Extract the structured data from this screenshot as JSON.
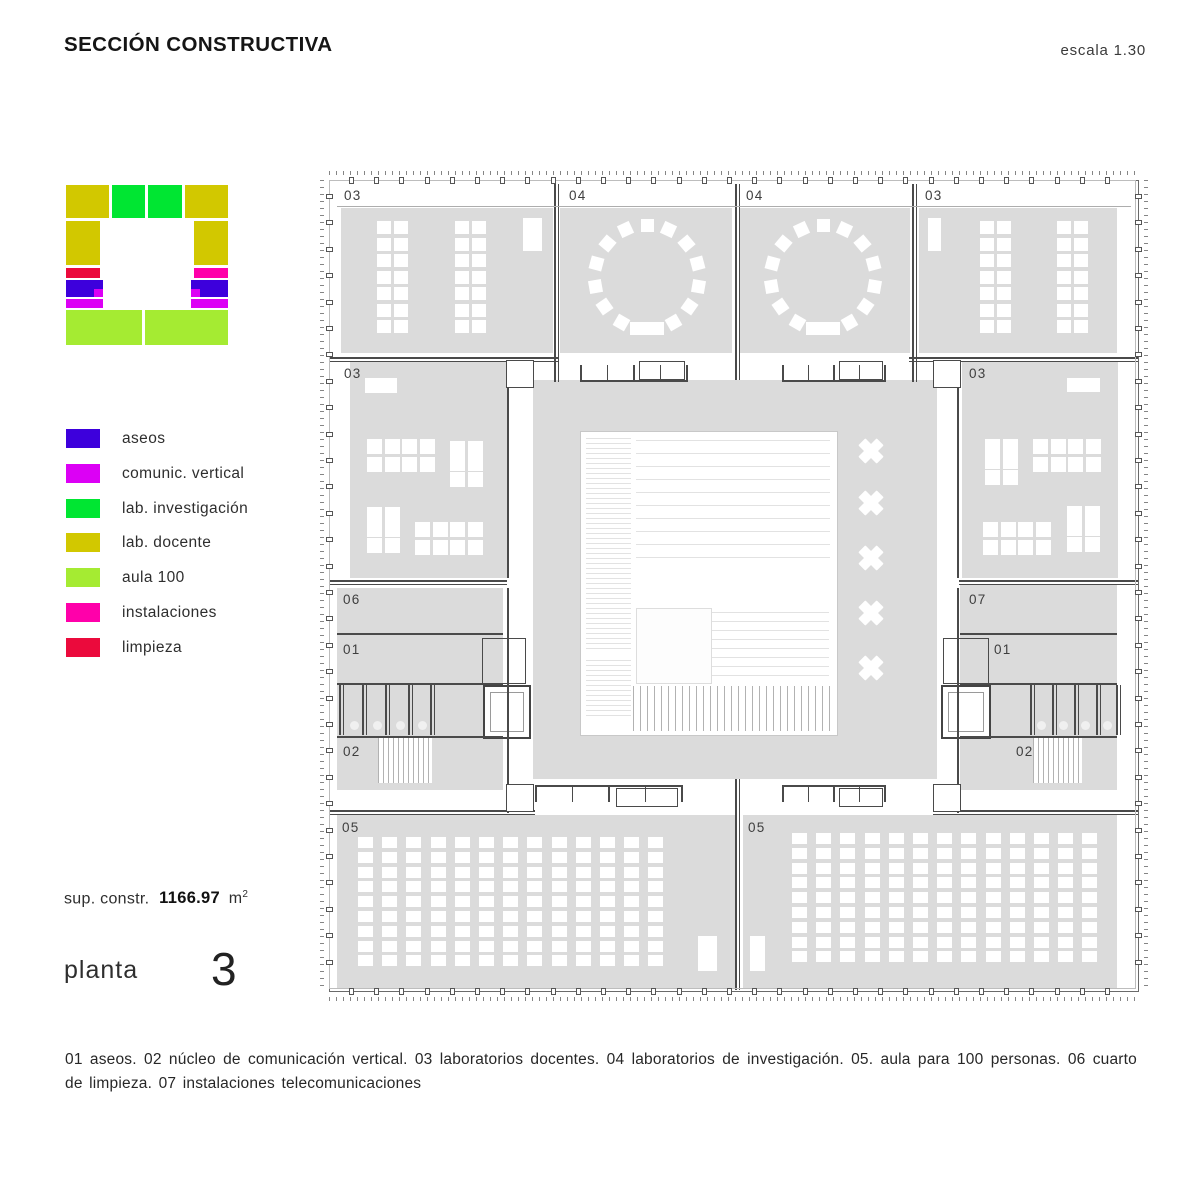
{
  "header": {
    "title": "SECCIÓN CONSTRUCTIVA",
    "scale": "escala 1.30"
  },
  "palette": {
    "aseos": "#3D00DC",
    "comunic": "#DC00F5",
    "invest": "#00E632",
    "docente": "#D2C800",
    "aula": "#A5EB32",
    "instal": "#FF00AA",
    "limpieza": "#EB0A3C"
  },
  "legend": {
    "items": [
      {
        "key": "aseos",
        "label": "aseos"
      },
      {
        "key": "comunic",
        "label": "comunic. vertical"
      },
      {
        "key": "invest",
        "label": "lab. investigación"
      },
      {
        "key": "docente",
        "label": "lab. docente"
      },
      {
        "key": "aula",
        "label": "aula 100"
      },
      {
        "key": "instal",
        "label": "instalaciones"
      },
      {
        "key": "limpieza",
        "label": "limpieza"
      }
    ]
  },
  "key_plan": {
    "blocks": [
      {
        "x": 0,
        "y": 2,
        "w": 43,
        "h": 33,
        "k": "docente"
      },
      {
        "x": 46,
        "y": 2,
        "w": 33,
        "h": 33,
        "k": "invest"
      },
      {
        "x": 82,
        "y": 2,
        "w": 34,
        "h": 33,
        "k": "invest"
      },
      {
        "x": 119,
        "y": 2,
        "w": 43,
        "h": 33,
        "k": "docente"
      },
      {
        "x": 0,
        "y": 38,
        "w": 34,
        "h": 44,
        "k": "docente"
      },
      {
        "x": 128,
        "y": 38,
        "w": 34,
        "h": 44,
        "k": "docente"
      },
      {
        "x": 0,
        "y": 85,
        "w": 34,
        "h": 10,
        "k": "limpieza"
      },
      {
        "x": 128,
        "y": 85,
        "w": 34,
        "h": 10,
        "k": "instal"
      },
      {
        "x": 0,
        "y": 97,
        "w": 37,
        "h": 17,
        "k": "aseos"
      },
      {
        "x": 125,
        "y": 97,
        "w": 37,
        "h": 17,
        "k": "aseos"
      },
      {
        "x": 28,
        "y": 106,
        "w": 9,
        "h": 8,
        "k": "comunic"
      },
      {
        "x": 125,
        "y": 106,
        "w": 9,
        "h": 8,
        "k": "comunic"
      },
      {
        "x": 0,
        "y": 116,
        "w": 37,
        "h": 9,
        "k": "comunic"
      },
      {
        "x": 125,
        "y": 116,
        "w": 37,
        "h": 9,
        "k": "comunic"
      },
      {
        "x": 0,
        "y": 127,
        "w": 76,
        "h": 35,
        "k": "aula"
      },
      {
        "x": 79,
        "y": 127,
        "w": 83,
        "h": 35,
        "k": "aula"
      }
    ]
  },
  "stats": {
    "prefix": "sup. constr.",
    "value": "1166.97",
    "unit": "m",
    "sup": "2"
  },
  "floor": {
    "label": "planta",
    "number": "3"
  },
  "caption": {
    "text": "01 aseos. 02 núcleo de comunicación vertical. 03 laboratorios docentes. 04 laboratorios de investigación. 05. aula para 100 personas. 06 cuarto de limpieza. 07 instalaciones telecomunicaciones"
  },
  "plan": {
    "room_fill": "#dbdbdb",
    "wall_color": "#4a4a4a",
    "rooms": [
      {
        "label": "03",
        "x": 12,
        "y": 28,
        "w": 212,
        "h": 145,
        "lx": 15,
        "ly": 8
      },
      {
        "label": "04",
        "x": 231,
        "y": 28,
        "w": 172,
        "h": 145,
        "lx": 240,
        "ly": 8
      },
      {
        "label": "04",
        "x": 411,
        "y": 28,
        "w": 170,
        "h": 145,
        "lx": 417,
        "ly": 8
      },
      {
        "label": "03",
        "x": 590,
        "y": 28,
        "w": 198,
        "h": 145,
        "lx": 596,
        "ly": 8
      },
      {
        "label": "03",
        "x": 21,
        "y": 182,
        "w": 157,
        "h": 216,
        "lx": 15,
        "ly": 186
      },
      {
        "label": "03",
        "x": 633,
        "y": 182,
        "w": 156,
        "h": 216,
        "lx": 640,
        "ly": 186
      },
      {
        "label": "06",
        "x": 8,
        "y": 408,
        "w": 166,
        "h": 45,
        "lx": 14,
        "ly": 412
      },
      {
        "label": "07",
        "x": 631,
        "y": 405,
        "w": 157,
        "h": 48,
        "lx": 640,
        "ly": 412
      },
      {
        "label": "01",
        "x": 8,
        "y": 454,
        "w": 166,
        "h": 102,
        "lx": 14,
        "ly": 462
      },
      {
        "label": "01",
        "x": 631,
        "y": 454,
        "w": 157,
        "h": 102,
        "lx": 665,
        "ly": 462
      },
      {
        "label": "02",
        "x": 8,
        "y": 557,
        "w": 166,
        "h": 53,
        "lx": 14,
        "ly": 564
      },
      {
        "label": "02",
        "x": 631,
        "y": 557,
        "w": 157,
        "h": 53,
        "lx": 687,
        "ly": 564
      },
      {
        "label": "05",
        "x": 8,
        "y": 635,
        "w": 398,
        "h": 174,
        "lx": 13,
        "ly": 640
      },
      {
        "label": "05",
        "x": 414,
        "y": 635,
        "w": 374,
        "h": 174,
        "lx": 419,
        "ly": 640
      },
      {
        "label": "",
        "x": 204,
        "y": 200,
        "w": 404,
        "h": 399,
        "lx": 0,
        "ly": 0
      }
    ],
    "courtyard": {
      "x": 251,
      "y": 251,
      "w": 256,
      "h": 303
    },
    "louvers": [
      {
        "x": 257,
        "y": 258,
        "w": 45,
        "h": 212,
        "p": 5
      },
      {
        "x": 307,
        "y": 260,
        "w": 194,
        "h": 128,
        "p": 13
      },
      {
        "x": 382,
        "y": 432,
        "w": 118,
        "h": 66,
        "p": 9
      },
      {
        "x": 257,
        "y": 480,
        "w": 45,
        "h": 58,
        "p": 5
      }
    ],
    "panels": [
      {
        "x": 307,
        "y": 428,
        "w": 74,
        "h": 74
      }
    ],
    "stairs": [
      {
        "x": 304,
        "y": 506,
        "w": 198,
        "h": 45,
        "p": 7
      },
      {
        "x": 49,
        "y": 558,
        "w": 54,
        "h": 45,
        "p": 5
      },
      {
        "x": 704,
        "y": 557,
        "w": 49,
        "h": 46,
        "p": 5
      }
    ],
    "xcolumns": {
      "cx": 542,
      "size": 26,
      "ys": [
        271,
        323,
        378,
        433,
        488
      ]
    },
    "grids": [
      {
        "x": 48,
        "y": 41,
        "cols": 2,
        "rows": 7,
        "cw": 14,
        "ch": 13,
        "px": 17,
        "py": 16.5
      },
      {
        "x": 126,
        "y": 41,
        "cols": 2,
        "rows": 7,
        "cw": 14,
        "ch": 13,
        "px": 17,
        "py": 16.5
      },
      {
        "x": 651,
        "y": 41,
        "cols": 2,
        "rows": 7,
        "cw": 14,
        "ch": 13,
        "px": 17,
        "py": 16.5
      },
      {
        "x": 728,
        "y": 41,
        "cols": 2,
        "rows": 7,
        "cw": 14,
        "ch": 13,
        "px": 17,
        "py": 16.5
      },
      {
        "x": 38,
        "y": 259,
        "cols": 4,
        "rows": 2,
        "cw": 15,
        "ch": 15,
        "px": 17.5,
        "py": 17.5
      },
      {
        "x": 121,
        "y": 261,
        "cols": 2,
        "rows": 3,
        "cw": 15,
        "ch": 15,
        "px": 17.5,
        "py": 15.3
      },
      {
        "x": 38,
        "y": 327,
        "cols": 2,
        "rows": 3,
        "cw": 15,
        "ch": 15,
        "px": 17.5,
        "py": 15.3
      },
      {
        "x": 86,
        "y": 342,
        "cols": 4,
        "rows": 2,
        "cw": 15,
        "ch": 15,
        "px": 17.5,
        "py": 17.5
      },
      {
        "x": 656,
        "y": 259,
        "cols": 2,
        "rows": 3,
        "cw": 15,
        "ch": 15,
        "px": 17.5,
        "py": 15.3
      },
      {
        "x": 704,
        "y": 259,
        "cols": 4,
        "rows": 2,
        "cw": 15,
        "ch": 15,
        "px": 17.5,
        "py": 17.5
      },
      {
        "x": 654,
        "y": 342,
        "cols": 4,
        "rows": 2,
        "cw": 15,
        "ch": 15,
        "px": 17.5,
        "py": 17.5
      },
      {
        "x": 738,
        "y": 326,
        "cols": 2,
        "rows": 3,
        "cw": 15,
        "ch": 15,
        "px": 17.5,
        "py": 15.3
      },
      {
        "x": 29,
        "y": 657,
        "cols": 13,
        "rows": 9,
        "cw": 15,
        "ch": 11,
        "px": 24.2,
        "py": 14.8
      },
      {
        "x": 463,
        "y": 653,
        "cols": 13,
        "rows": 9,
        "cw": 15,
        "ch": 11,
        "px": 24.2,
        "py": 14.8
      }
    ],
    "rects": [
      {
        "x": 194,
        "y": 38,
        "w": 19,
        "h": 33
      },
      {
        "x": 599,
        "y": 38,
        "w": 13,
        "h": 33
      },
      {
        "x": 36,
        "y": 198,
        "w": 32,
        "h": 15
      },
      {
        "x": 738,
        "y": 198,
        "w": 33,
        "h": 14
      },
      {
        "x": 301,
        "y": 142,
        "w": 34,
        "h": 13
      },
      {
        "x": 477,
        "y": 142,
        "w": 34,
        "h": 13
      },
      {
        "x": 369,
        "y": 756,
        "w": 19,
        "h": 35
      },
      {
        "x": 421,
        "y": 756,
        "w": 15,
        "h": 35
      }
    ],
    "rings": [
      {
        "cx": 318,
        "cy": 97,
        "r": 52,
        "n": 13,
        "s": 13,
        "start": 120,
        "step": 25
      },
      {
        "cx": 494,
        "cy": 97,
        "r": 52,
        "n": 13,
        "s": 13,
        "start": 120,
        "step": 25
      }
    ],
    "walls": [
      {
        "x": 225,
        "y": 4,
        "w": 1.5,
        "h": 198
      },
      {
        "x": 228.5,
        "y": 4,
        "w": 1.5,
        "h": 198
      },
      {
        "x": 406,
        "y": 4,
        "w": 1.5,
        "h": 196
      },
      {
        "x": 409.5,
        "y": 4,
        "w": 1.5,
        "h": 196
      },
      {
        "x": 583,
        "y": 4,
        "w": 1.5,
        "h": 198
      },
      {
        "x": 586.5,
        "y": 4,
        "w": 1.5,
        "h": 198
      },
      {
        "x": 406,
        "y": 599,
        "w": 1.5,
        "h": 211
      },
      {
        "x": 409.5,
        "y": 599,
        "w": 1.5,
        "h": 211
      },
      {
        "x": 178,
        "y": 182,
        "w": 1.5,
        "h": 216
      },
      {
        "x": 628,
        "y": 182,
        "w": 1.5,
        "h": 216
      },
      {
        "x": 178,
        "y": 408,
        "w": 1.5,
        "h": 225
      },
      {
        "x": 628,
        "y": 408,
        "w": 1.5,
        "h": 225
      },
      {
        "x": 0,
        "y": 177,
        "w": 230,
        "h": 1.5
      },
      {
        "x": 0,
        "y": 180.5,
        "w": 230,
        "h": 1.5
      },
      {
        "x": 580,
        "y": 177,
        "w": 230,
        "h": 1.5
      },
      {
        "x": 580,
        "y": 180.5,
        "w": 230,
        "h": 1.5
      },
      {
        "x": 0,
        "y": 400,
        "w": 178,
        "h": 1.5
      },
      {
        "x": 0,
        "y": 403.5,
        "w": 178,
        "h": 1.5
      },
      {
        "x": 630,
        "y": 400,
        "w": 180,
        "h": 1.5
      },
      {
        "x": 630,
        "y": 403.5,
        "w": 180,
        "h": 1.5
      },
      {
        "x": 8,
        "y": 453,
        "w": 166,
        "h": 1.5
      },
      {
        "x": 631,
        "y": 453,
        "w": 157,
        "h": 1.5
      },
      {
        "x": 8,
        "y": 503,
        "w": 166,
        "h": 1.5
      },
      {
        "x": 631,
        "y": 503,
        "w": 157,
        "h": 1.5
      },
      {
        "x": 8,
        "y": 556,
        "w": 166,
        "h": 1.5
      },
      {
        "x": 631,
        "y": 556,
        "w": 157,
        "h": 1.5
      },
      {
        "x": 0,
        "y": 630,
        "w": 206,
        "h": 1.5
      },
      {
        "x": 0,
        "y": 633.5,
        "w": 206,
        "h": 1.5
      },
      {
        "x": 604,
        "y": 630,
        "w": 206,
        "h": 1.5
      },
      {
        "x": 604,
        "y": 633.5,
        "w": 206,
        "h": 1.5
      }
    ],
    "lines": [
      {
        "x": 8,
        "y": 26,
        "w": 794,
        "h": 1
      }
    ],
    "benches": [
      {
        "x": 251,
        "y": 178,
        "w": 108,
        "flip": false
      },
      {
        "x": 453,
        "y": 178,
        "w": 104,
        "flip": false
      },
      {
        "x": 206,
        "y": 605,
        "w": 148,
        "flip": true
      },
      {
        "x": 453,
        "y": 605,
        "w": 104,
        "flip": true
      }
    ],
    "corners": [
      {
        "x": 177,
        "y": 180
      },
      {
        "x": 604,
        "y": 180
      },
      {
        "x": 177,
        "y": 604
      },
      {
        "x": 604,
        "y": 604
      }
    ],
    "stalls": [
      {
        "xs": [
          10,
          33,
          56,
          79,
          101
        ],
        "y": 505,
        "h": 50
      },
      {
        "xs": [
          701,
          723,
          745,
          767,
          787
        ],
        "y": 505,
        "h": 50
      }
    ],
    "circles": [
      {
        "x": 25,
        "y": 545
      },
      {
        "x": 48,
        "y": 545
      },
      {
        "x": 71,
        "y": 545
      },
      {
        "x": 93,
        "y": 545
      },
      {
        "x": 712,
        "y": 545
      },
      {
        "x": 734,
        "y": 545
      },
      {
        "x": 756,
        "y": 545
      },
      {
        "x": 778,
        "y": 545
      }
    ],
    "lifts": [
      {
        "x": 154,
        "y": 505,
        "w": 44,
        "h": 50
      },
      {
        "x": 612,
        "y": 505,
        "w": 46,
        "h": 50
      }
    ],
    "frames": [
      {
        "x": 153,
        "y": 458,
        "w": 42,
        "h": 44
      },
      {
        "x": 614,
        "y": 458,
        "w": 44,
        "h": 44
      }
    ]
  }
}
